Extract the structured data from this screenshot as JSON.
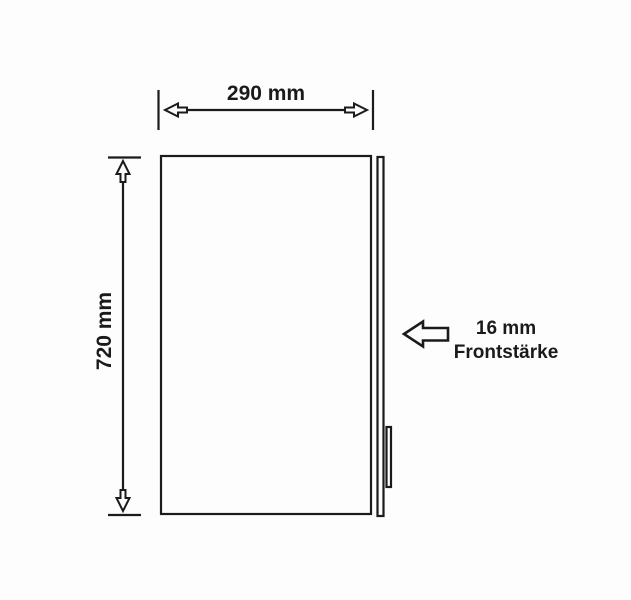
{
  "diagram": {
    "colors": {
      "background": "#fdfdfd",
      "line": "#1b1b1b",
      "text": "#1a1a1a"
    },
    "width_dimension": {
      "label": "290 mm"
    },
    "height_dimension": {
      "label": "720 mm"
    },
    "thickness_annotation": {
      "line1": "16 mm",
      "line2": "Frontstärke"
    }
  }
}
